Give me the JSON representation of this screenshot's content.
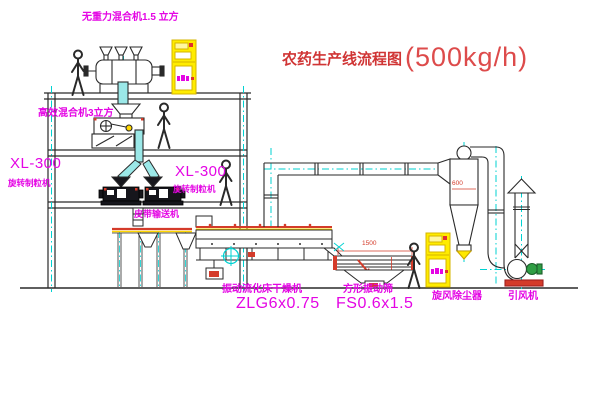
{
  "title": {
    "name": "农药生产线流程图",
    "capacity": "(500kg/h)"
  },
  "equipment_labels": {
    "gravity_free_mixer": "无重力混合机1.5 立方",
    "high_efficiency_mixer": "高效混合机3立方",
    "granulator_left": {
      "model": "XL-300",
      "name": "旋转制粒机"
    },
    "granulator_right": {
      "model": "XL-300",
      "name": "旋转制粒机"
    },
    "belt_conveyor": "皮带输送机",
    "fluid_bed_dryer": {
      "name": "振动流化床干燥机",
      "model": "ZLG6x0.75"
    },
    "square_vibrating_sieve": {
      "name": "方形振动筛",
      "model": "FS0.6x1.5"
    },
    "cyclone_dust_collector": "旋风除尘器",
    "induced_draft_fan": "引风机"
  },
  "dimensions": {
    "sieve_length_mm": "1500",
    "cyclone_dia_mm": "600"
  },
  "colors": {
    "label_magenta": "#e405e4",
    "title_red": "#d03535",
    "accent_red": "#d43b2a",
    "centerline_cyan": "#00d2d2",
    "cabinet_yellow": "#ffec00",
    "motor_green": "#2f9e44",
    "line_dark": "#2a2a2a"
  }
}
